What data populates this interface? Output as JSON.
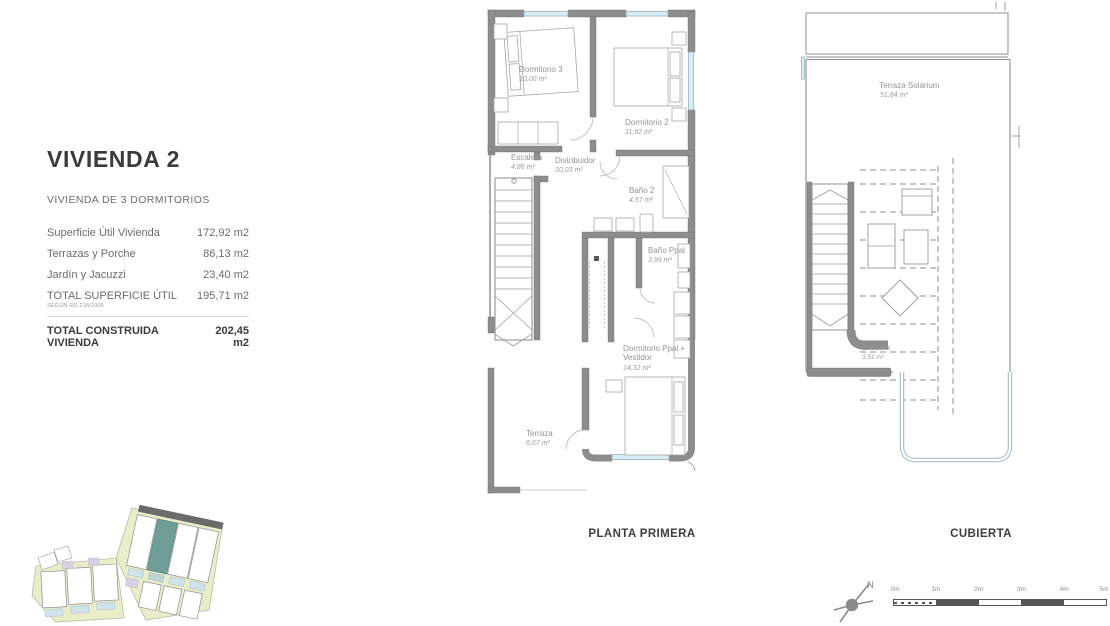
{
  "info_panel": {
    "title": "VIVIENDA 2",
    "subtitle": "VIVIENDA DE 3 DORMITORIOS",
    "rows": [
      {
        "label": "Superficie Útil Vivienda",
        "value": "172,92 m2"
      },
      {
        "label": "Terrazas y Porche",
        "value": "86,13 m2"
      },
      {
        "label": "Jardín y Jacuzzi",
        "value": "23,40 m2"
      },
      {
        "label": "TOTAL SUPERFICIE ÚTIL",
        "note": "SEGÚN RD 218/2005",
        "value": "195,71 m2"
      },
      {
        "label": "TOTAL CONSTRUIDA VIVIENDA",
        "value": "202,45 m2"
      }
    ]
  },
  "plans": {
    "p1": {
      "title": "PLANTA PRIMERA",
      "rooms": [
        {
          "name": "Dormitorio 3",
          "area": "10,00 m²"
        },
        {
          "name": "Dormitorio 2",
          "area": "11,92 m²"
        },
        {
          "name": "Escalera",
          "area": "4,86 m²"
        },
        {
          "name": "Distribuidor",
          "area": "10,03 m²"
        },
        {
          "name": "Baño 2",
          "area": "4,57 m²"
        },
        {
          "name": "Baño Ppal",
          "area": "3,99 m²"
        },
        {
          "name_lines": [
            "Dormitorio Ppal +",
            "Vestidor"
          ],
          "area": "14,32 m²"
        },
        {
          "name": "Terraza",
          "area": "6,67 m²"
        }
      ]
    },
    "p2": {
      "title": "CUBIERTA",
      "rooms": [
        {
          "name": "Terraza Solarium",
          "area": "51,84 m²"
        },
        {
          "name": "Escalera",
          "area": "3,51 m²"
        }
      ]
    }
  },
  "compass": {
    "north_label": "N"
  },
  "scale_bar": {
    "labels": [
      "0m",
      "1m",
      "2m",
      "3m",
      "4m",
      "5m"
    ]
  },
  "colors": {
    "wall": "#8d8d8d",
    "window": "#d9edf6",
    "site_ground": "#e9edca",
    "highlight_unit": "#6f9e98",
    "text_dark": "#3b3b3b",
    "text_gray": "#949494"
  }
}
